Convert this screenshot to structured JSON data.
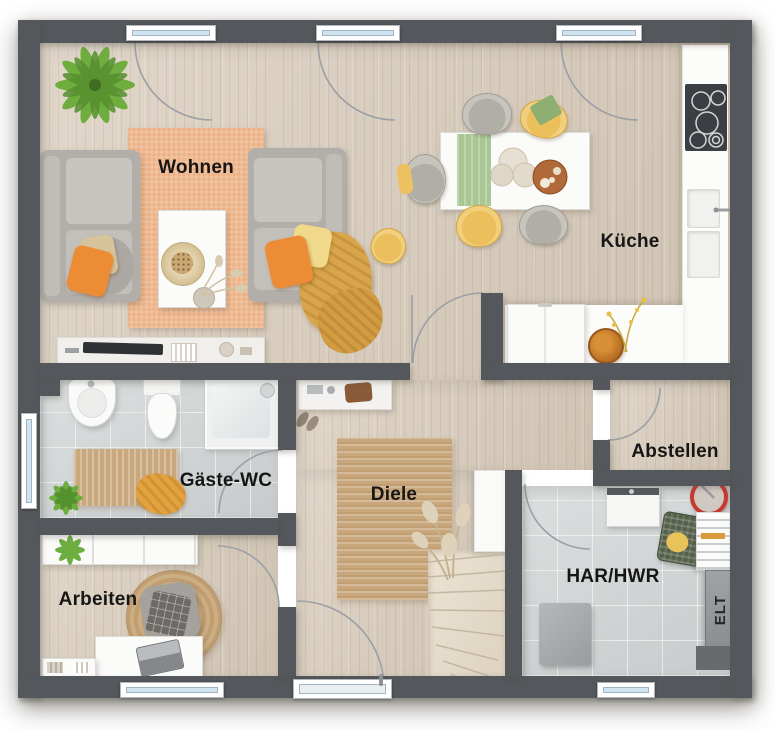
{
  "plan": {
    "type": "floor-plan-ground-floor",
    "labels": {
      "wohnen": "Wohnen",
      "kueche": "Küche",
      "gaeste_wc": "Gäste-WC",
      "diele": "Diele",
      "abstellen": "Abstellen",
      "arbeiten": "Arbeiten",
      "har_hwr": "HAR/HWR",
      "elt": "ELT"
    },
    "colors": {
      "wall": "#54575b",
      "wood_floor": "#d7ccbd",
      "tile_floor": "#d2d6d7",
      "rug_living": "#f0ba92",
      "rug_jute": "#c9a77c",
      "accent_orange": "#ec8d35",
      "accent_yellow": "#eabf5c",
      "accent_green": "#a9c795",
      "sofa_gray": "#b2aea9",
      "window_glass": "#cfe4f0",
      "blanket_mustard": "#d9a54b"
    },
    "furniture": {
      "wohnen": [
        "potted-plant",
        "area-rug",
        "sofa-left",
        "sofa-right",
        "coffee-table",
        "tv-sideboard",
        "cushions",
        "throw-blanket"
      ],
      "essbereich": [
        "dining-table",
        "table-runner",
        "dried-flowers",
        "serving-bowl",
        "dining-chairs"
      ],
      "kueche": [
        "cooktop",
        "double-sink",
        "kitchen-counter",
        "fridge",
        "fruit-bowl",
        "flower-sprigs"
      ],
      "gaeste_wc": [
        "washbasin",
        "toilet",
        "shower",
        "bath-mat",
        "towel",
        "plant"
      ],
      "diele": [
        "sideboard",
        "shoes",
        "jute-rug",
        "pampas-plant",
        "winder-staircase",
        "entrance-door"
      ],
      "arbeiten": [
        "wall-shelf",
        "plant",
        "desk",
        "laptop",
        "office-chair",
        "round-rug",
        "low-board",
        "books"
      ],
      "har_hwr": [
        "washing-machine",
        "laundry-basket",
        "drying-rack",
        "bucket",
        "appliance",
        "electrical-panel",
        "door-mat"
      ]
    }
  }
}
